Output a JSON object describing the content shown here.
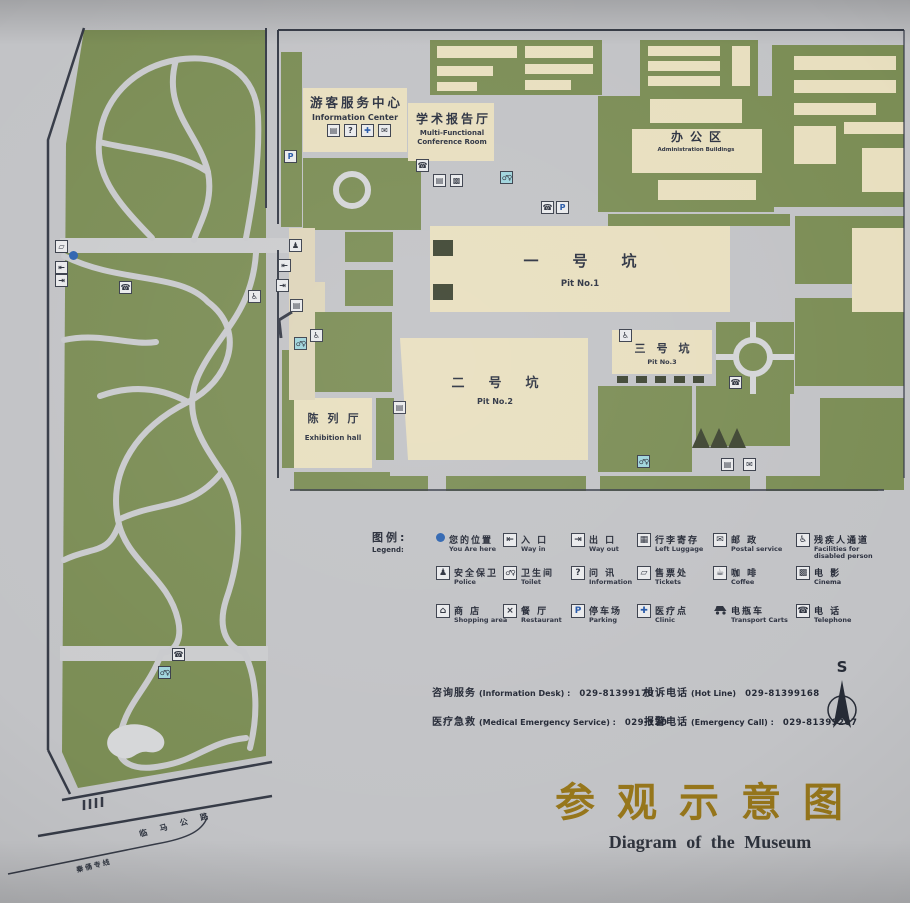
{
  "map": {
    "buildings": {
      "info_center": {
        "zh": "游客服务中心",
        "en": "Information Center"
      },
      "conference": {
        "zh": "学术报告厅",
        "en": "Multi-Functional Conference Room"
      },
      "admin": {
        "zh": "办公区",
        "en": "Administration Buildings"
      },
      "pit1": {
        "zh": "一号坑",
        "en": "Pit No.1"
      },
      "pit2": {
        "zh": "二号坑",
        "en": "Pit No.2"
      },
      "pit3": {
        "zh": "三号坑",
        "en": "Pit No.3"
      },
      "exhibition": {
        "zh": "陈列厅",
        "en": "Exhibition hall"
      }
    },
    "roads": {
      "highway": "临马公路",
      "busline": "秦俑专线"
    }
  },
  "icons": {
    "you_are_here": "●",
    "way_in": "⇤",
    "way_out": "⇥",
    "left_luggage": "▦",
    "postal": "✉",
    "disabled": "♿",
    "police": "♟",
    "toilet": "♂♀",
    "information": "?",
    "tickets": "▱",
    "coffee": "☕",
    "cinema": "▩",
    "shop": "⌂",
    "kiosk": "▤",
    "restaurant": "×",
    "parking": "P",
    "clinic": "✚",
    "transport": "",
    "telephone": "☎"
  },
  "legend": {
    "title_zh": "图例:",
    "title_en": "Legend:",
    "rows": [
      [
        {
          "icon": "you_are_here",
          "zh": "您的位置",
          "en": "You Are here"
        },
        {
          "icon": "way_in",
          "zh": "入 口",
          "en": "Way in"
        },
        {
          "icon": "way_out",
          "zh": "出 口",
          "en": "Way out"
        },
        {
          "icon": "left_luggage",
          "zh": "行李寄存",
          "en": "Left Luggage"
        },
        {
          "icon": "postal",
          "zh": "邮 政",
          "en": "Postal service"
        },
        {
          "icon": "disabled",
          "zh": "残疾人通道",
          "en": "Facilities for disabled person"
        }
      ],
      [
        {
          "icon": "police",
          "zh": "安全保卫",
          "en": "Police"
        },
        {
          "icon": "toilet",
          "zh": "卫生间",
          "en": "Toilet"
        },
        {
          "icon": "information",
          "zh": "问 讯",
          "en": "Information"
        },
        {
          "icon": "tickets",
          "zh": "售票处",
          "en": "Tickets"
        },
        {
          "icon": "coffee",
          "zh": "咖 啡",
          "en": "Coffee"
        },
        {
          "icon": "cinema",
          "zh": "电 影",
          "en": "Cinema"
        }
      ],
      [
        {
          "icon": "shop",
          "zh": "商 店",
          "en": "Shopping area"
        },
        {
          "icon": "restaurant",
          "zh": "餐 厅",
          "en": "Restaurant"
        },
        {
          "icon": "parking",
          "zh": "停车场",
          "en": "Parking"
        },
        {
          "icon": "clinic",
          "zh": "医疗点",
          "en": "Clinic"
        },
        {
          "icon": "transport",
          "zh": "电瓶车",
          "en": "Transport Carts"
        },
        {
          "icon": "telephone",
          "zh": "电 话",
          "en": "Telephone"
        }
      ]
    ]
  },
  "contacts": [
    {
      "zh": "咨询服务",
      "en": "(Information Desk) :",
      "number": "029-81399170"
    },
    {
      "zh": "投诉电话",
      "en": "(Hot Line)",
      "number": "029-81399168"
    },
    {
      "zh": "医疗急救",
      "en": "(Medical Emergency Service) :",
      "number": "029-120"
    },
    {
      "zh": "报警电话",
      "en": "(Emergency Call) :",
      "number": "029-81399207"
    }
  ],
  "compass": {
    "label": "S"
  },
  "title": {
    "zh": "参观示意图",
    "en": "Diagram of the Museum"
  },
  "colors": {
    "green": "#7b8d55",
    "building_beige": "#e8dfbf",
    "path_gray": "#c9cacd",
    "dark_line": "#363b47",
    "accent_blue": "#2e64b0",
    "toilet_cyan": "#9fd4dc",
    "title_gold": "#96761b",
    "pond_white": "#d6d7d9"
  },
  "map_icons": [
    {
      "icon": "parking",
      "x": 284,
      "y": 150,
      "style": "blue"
    },
    {
      "icon": "kiosk",
      "x": 327,
      "y": 124
    },
    {
      "icon": "information",
      "x": 344,
      "y": 124
    },
    {
      "icon": "clinic",
      "x": 361,
      "y": 124,
      "style": "blue"
    },
    {
      "icon": "postal",
      "x": 378,
      "y": 124
    },
    {
      "icon": "telephone",
      "x": 416,
      "y": 159
    },
    {
      "icon": "kiosk",
      "x": 433,
      "y": 174
    },
    {
      "icon": "cinema",
      "x": 450,
      "y": 174
    },
    {
      "icon": "toilet",
      "x": 500,
      "y": 171,
      "style": "wc cyan"
    },
    {
      "icon": "telephone",
      "x": 541,
      "y": 201
    },
    {
      "icon": "parking",
      "x": 556,
      "y": 201,
      "style": "blue"
    },
    {
      "icon": "disabled",
      "x": 619,
      "y": 329
    },
    {
      "icon": "telephone",
      "x": 729,
      "y": 376
    },
    {
      "icon": "police",
      "x": 289,
      "y": 239
    },
    {
      "icon": "way_in",
      "x": 278,
      "y": 259
    },
    {
      "icon": "way_out",
      "x": 276,
      "y": 279
    },
    {
      "icon": "disabled",
      "x": 248,
      "y": 290
    },
    {
      "icon": "kiosk",
      "x": 290,
      "y": 299
    },
    {
      "icon": "disabled",
      "x": 310,
      "y": 329
    },
    {
      "icon": "toilet",
      "x": 294,
      "y": 337,
      "style": "wc cyan"
    },
    {
      "icon": "tickets",
      "x": 55,
      "y": 240
    },
    {
      "icon": "you_are_here",
      "x": 69,
      "y": 251,
      "style": "dot"
    },
    {
      "icon": "way_in",
      "x": 55,
      "y": 261
    },
    {
      "icon": "way_out",
      "x": 55,
      "y": 274
    },
    {
      "icon": "telephone",
      "x": 119,
      "y": 281
    },
    {
      "icon": "telephone",
      "x": 172,
      "y": 648
    },
    {
      "icon": "toilet",
      "x": 158,
      "y": 666,
      "style": "wc cyan"
    },
    {
      "icon": "toilet",
      "x": 637,
      "y": 455,
      "style": "wc cyan"
    },
    {
      "icon": "kiosk",
      "x": 721,
      "y": 458
    },
    {
      "icon": "postal",
      "x": 743,
      "y": 458
    },
    {
      "icon": "kiosk",
      "x": 393,
      "y": 401
    }
  ]
}
